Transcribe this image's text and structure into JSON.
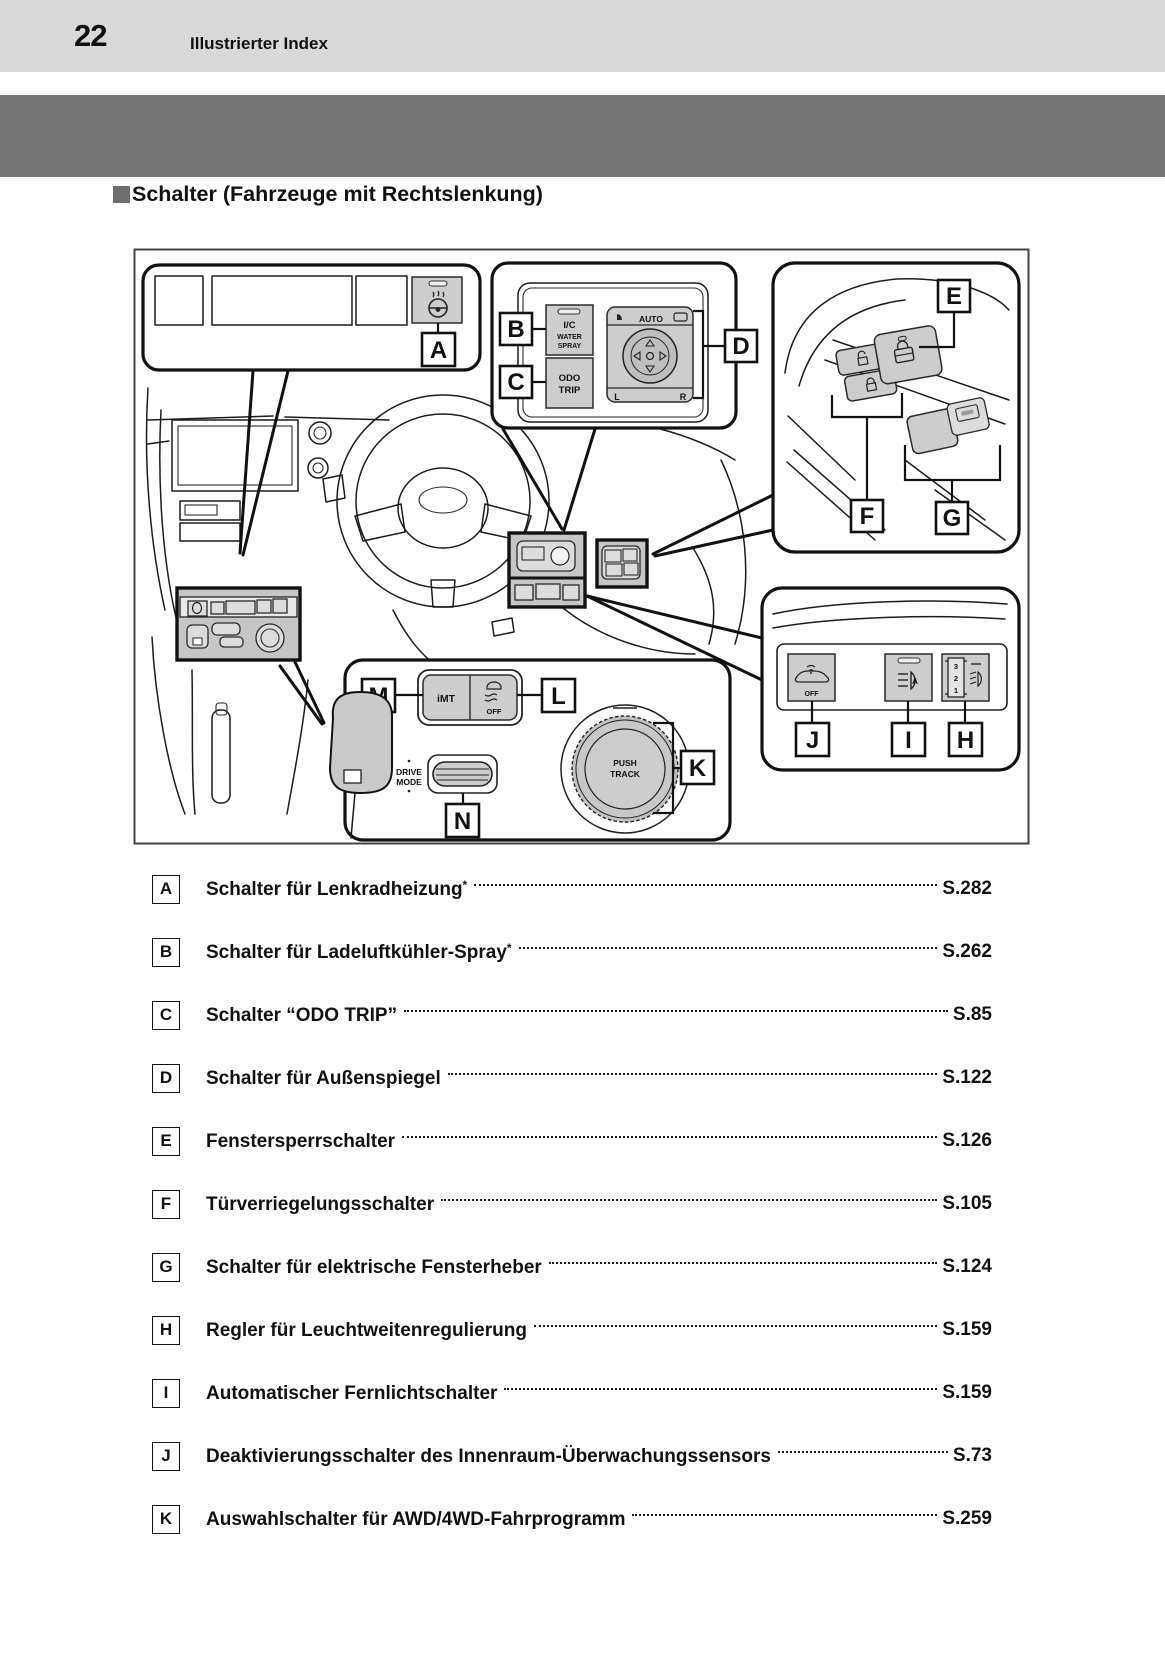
{
  "page": {
    "number": "22",
    "section_title": "Illustrierter Index"
  },
  "heading": {
    "text": "Schalter (Fahrzeuge mit Rechtslenkung)"
  },
  "colors": {
    "header_bar": "#d9d9d9",
    "banner": "#757575",
    "button_fill": "#cdcdcd",
    "line": "#111111"
  },
  "diagram": {
    "callouts": {
      "A": "A",
      "B": "B",
      "C": "C",
      "D": "D",
      "E": "E",
      "F": "F",
      "G": "G",
      "H": "H",
      "I": "I",
      "J": "J",
      "K": "K",
      "L": "L",
      "M": "M",
      "N": "N"
    },
    "switch_labels": {
      "ic": "I/C",
      "water": "WATER",
      "spray": "SPRAY",
      "odo": "ODO",
      "trip": "TRIP",
      "auto": "AUTO",
      "mirror_l": "L",
      "mirror_r": "R",
      "imt": "iMT",
      "vsc_off": "OFF",
      "drive": "DRIVE",
      "mode": "MODE",
      "push": "PUSH",
      "track": "TRACK",
      "sensor_off": "OFF",
      "level_3": "3",
      "level_2": "2",
      "level_1": "1",
      "zero": "0"
    }
  },
  "index": {
    "items": [
      {
        "key": "A",
        "label": "Schalter für Lenkradheizung",
        "sup": "*",
        "page": "S.282"
      },
      {
        "key": "B",
        "label": "Schalter für Ladeluftkühler-Spray",
        "sup": "*",
        "page": "S.262"
      },
      {
        "key": "C",
        "label": "Schalter “ODO TRIP”",
        "sup": "",
        "page": "S.85"
      },
      {
        "key": "D",
        "label": "Schalter für Außenspiegel",
        "sup": "",
        "page": "S.122"
      },
      {
        "key": "E",
        "label": "Fenstersperrschalter",
        "sup": "",
        "page": "S.126"
      },
      {
        "key": "F",
        "label": "Türverriegelungsschalter",
        "sup": "",
        "page": "S.105"
      },
      {
        "key": "G",
        "label": "Schalter für elektrische Fensterheber",
        "sup": "",
        "page": "S.124"
      },
      {
        "key": "H",
        "label": "Regler für Leuchtweitenregulierung",
        "sup": "",
        "page": "S.159"
      },
      {
        "key": "I",
        "label": "Automatischer Fernlichtschalter",
        "sup": "",
        "page": "S.159"
      },
      {
        "key": "J",
        "label": "Deaktivierungsschalter des Innenraum-Überwachungssensors",
        "sup": "",
        "page": "S.73"
      },
      {
        "key": "K",
        "label": "Auswahlschalter für AWD/4WD-Fahrprogramm",
        "sup": "",
        "page": "S.259"
      }
    ]
  }
}
